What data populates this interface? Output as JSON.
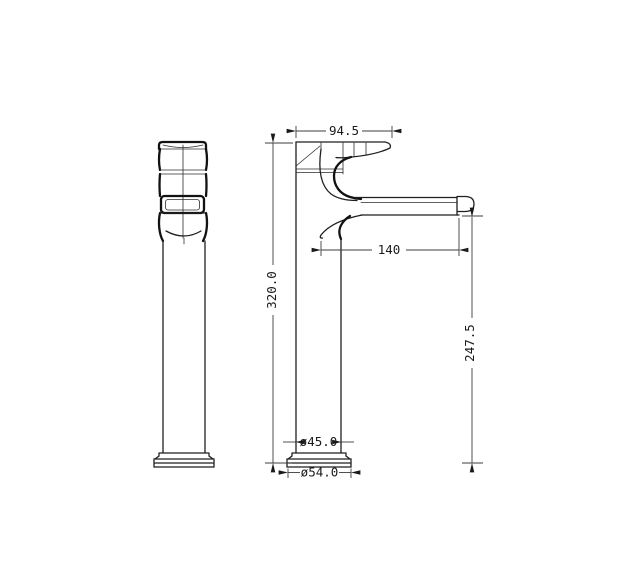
{
  "drawing": {
    "kind": "faucet technical drawing",
    "views": {
      "left": "side view",
      "right": "front view"
    }
  },
  "dimensions": {
    "handle_width": "94.5",
    "spout_reach": "140",
    "overall_height": "320.0",
    "spout_outlet_height": "247.5",
    "body_diameter": "ø45.0",
    "base_diameter": "ø54.0"
  },
  "colors": {
    "line": "#1f1f1f",
    "dimension_line": "#3d3d3d",
    "background": "#ffffff"
  }
}
